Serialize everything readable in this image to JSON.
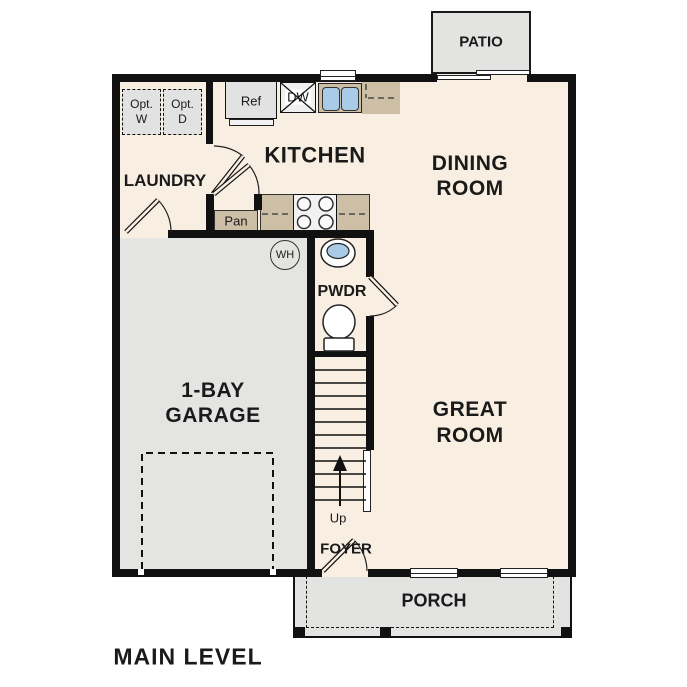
{
  "title": "MAIN LEVEL",
  "rooms": {
    "kitchen": {
      "label": "KITCHEN"
    },
    "dining": {
      "line1": "DINING",
      "line2": "ROOM"
    },
    "laundry": {
      "label": "LAUNDRY"
    },
    "garage": {
      "line1": "1-BAY",
      "line2": "GARAGE"
    },
    "great_room": {
      "line1": "GREAT",
      "line2": "ROOM"
    },
    "powder": {
      "label": "PWDR"
    },
    "foyer": {
      "label": "FOYER"
    },
    "patio": {
      "label": "PATIO"
    },
    "porch": {
      "label": "PORCH"
    }
  },
  "fixtures": {
    "refrigerator": "Ref",
    "dishwasher": "DW",
    "pantry": "Pan",
    "water_heater": "WH",
    "stairs_direction": "Up",
    "optional_washer_line1": "Opt.",
    "optional_washer_line2": "W",
    "optional_dryer_line1": "Opt.",
    "optional_dryer_line2": "D"
  },
  "colors": {
    "wall": "#111111",
    "interior_floor": "#f8efe2",
    "garage_floor": "#e4e4e2",
    "outdoor_surface": "#e3e3e1",
    "counter": "#ccbfa6",
    "sink_water": "#a9cbe8",
    "text": "#1a1a1a",
    "background": "#ffffff"
  }
}
